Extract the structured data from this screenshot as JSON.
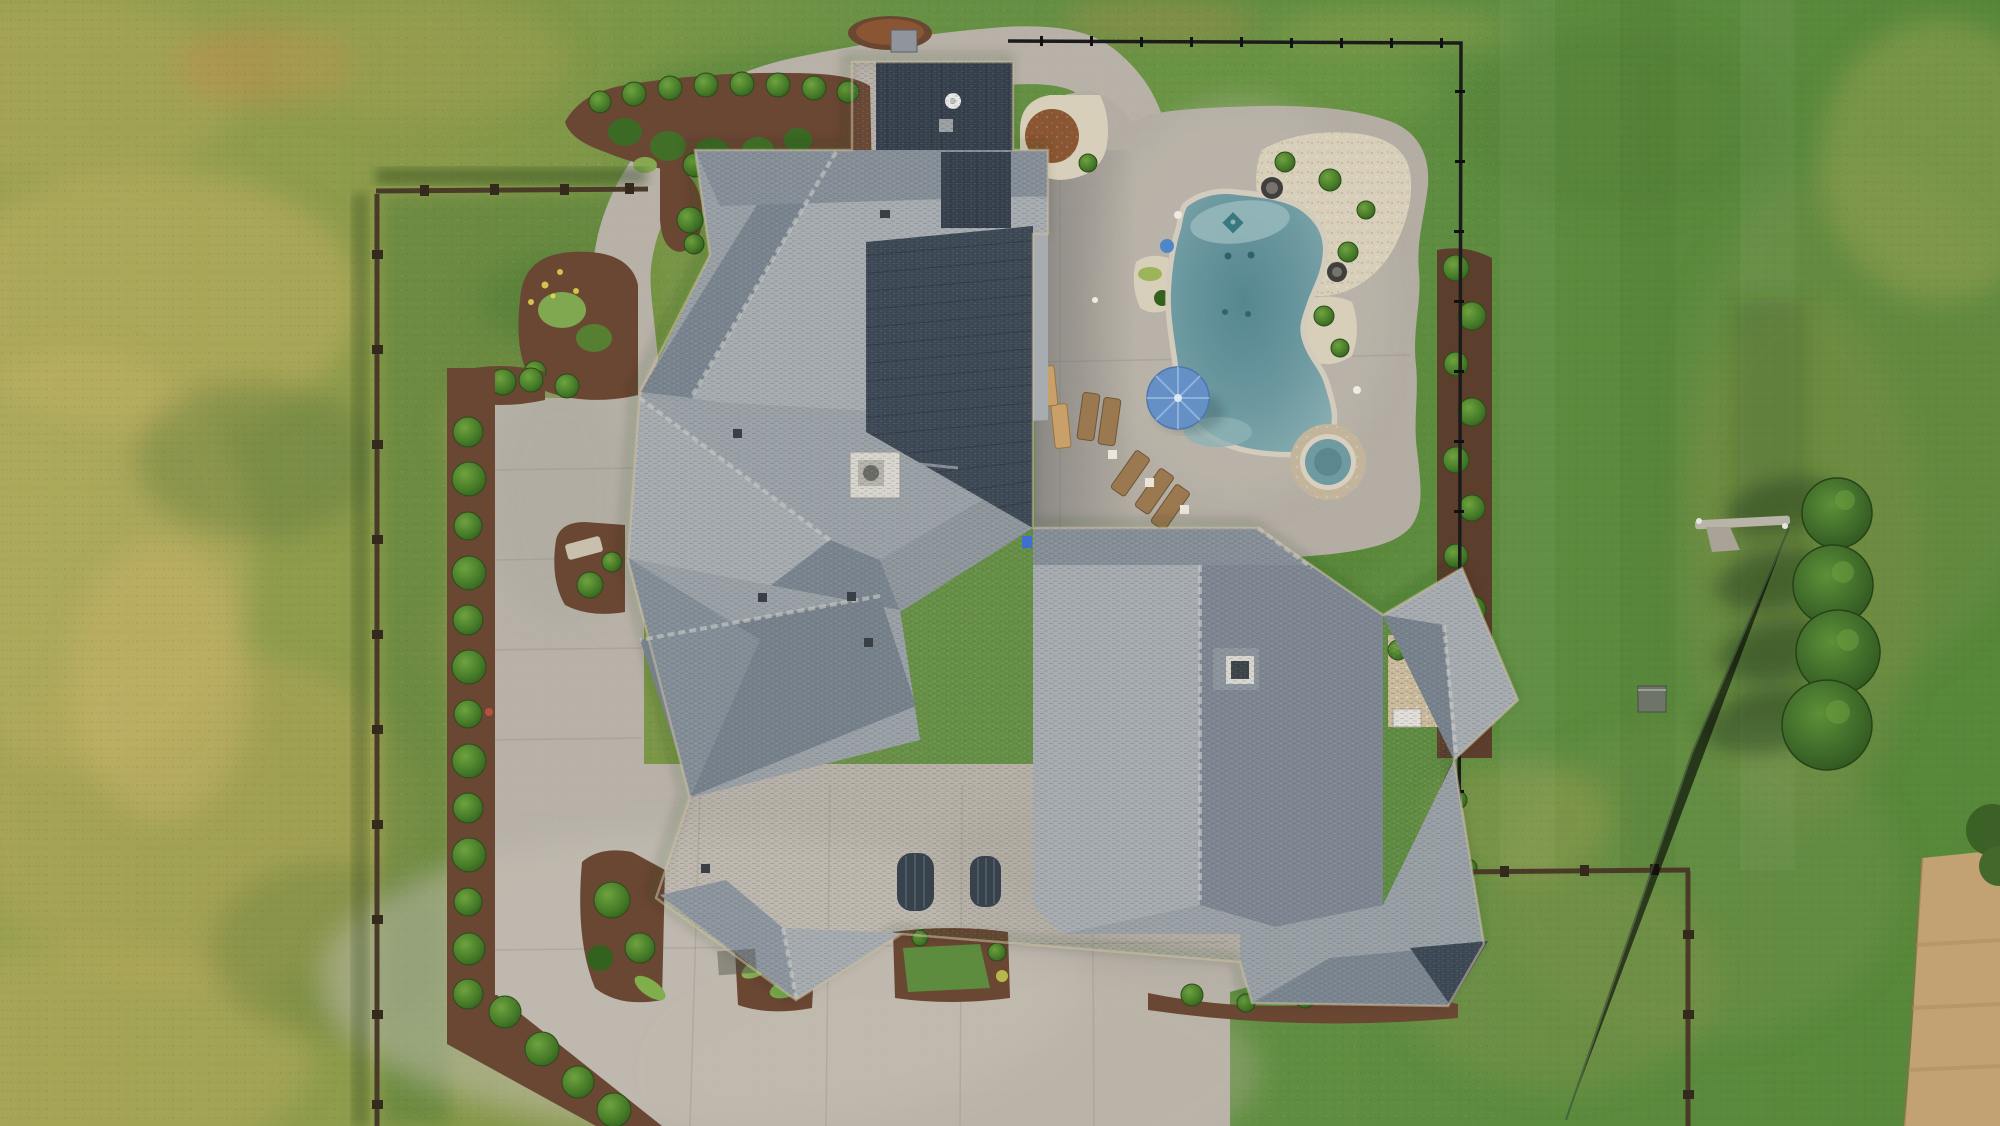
{
  "scene": {
    "type": "aerial-drone-photo",
    "view": "top-down",
    "subject": "Large single-family home with gray shingle roof, freeform swimming pool with spa, concrete motor court and landscaped fenced yard surrounded by patchy grass fields"
  },
  "palette": {
    "grass-left": "#97a04f",
    "grass-right": "#5d8c3f",
    "grass-rich": "#4f7e35",
    "grass-yellow": "#bcab5e",
    "grass-dark": "#3f6529",
    "concrete": "#b7b1a7",
    "concrete-light": "#c6c0b5",
    "deck": "#b3ada3",
    "roof-light": "#a7acb0",
    "roof-mid": "#99a0a5",
    "roof-dark": "#7a848e",
    "roof-band": "#868f97",
    "roof-metal": "#3c4754",
    "roof-metal-dark": "#353f4b",
    "coping": "#d3ccbd",
    "pool-edge": "#8fb3b5",
    "pool-deep": "#54858e",
    "pool-ledge": "#9dbec0",
    "spa-stone": "#c3b59c",
    "umbrella-blue": "#6590c5",
    "mulch": "#6a4733",
    "mulch-dark": "#5c3e2c",
    "bush-green": "#4c7f2d",
    "tree-green": "#3f6b2a",
    "gravel": "#d8cfba",
    "pebble": "#cdbc9c",
    "rust-bush": "#8a5532",
    "fence-wood": "#4a3b28",
    "fence-black": "#1b1b1b",
    "field-tan": "#c2a172",
    "lounger-wood": "#9a7850",
    "hvac-white": "#d9d6cf",
    "wire": "#394a39"
  },
  "objects": {
    "house": {
      "roof_style": "complex hip with metal accent sections",
      "accent_sections": 4,
      "skylights": 1,
      "hvac_units": 2,
      "window_awnings": 2
    },
    "pool": {
      "shape": "freeform",
      "features": [
        "tanning ledge",
        "round spa",
        "diamond tile inlay"
      ],
      "fire_bowls": 2
    },
    "pool_furniture": {
      "umbrella_color_key": "umbrella-blue",
      "loungers": 7,
      "side_tables": 3
    },
    "trees_right": {
      "count": 4,
      "form": "conical evergreens"
    },
    "driveway_border_bushes": {
      "count": 14
    },
    "courtyard_bushes": {
      "count": 8
    },
    "right_bed_bushes": {
      "count": 10
    },
    "fences": {
      "wood_rail": "left and bottom-right",
      "black_metal": "pool enclosure top-right"
    },
    "utilities": {
      "power_pole": 1,
      "power_line": 1,
      "utility_box": 1
    },
    "field_bottom_right": {
      "surface": "plowed tan dirt"
    }
  }
}
